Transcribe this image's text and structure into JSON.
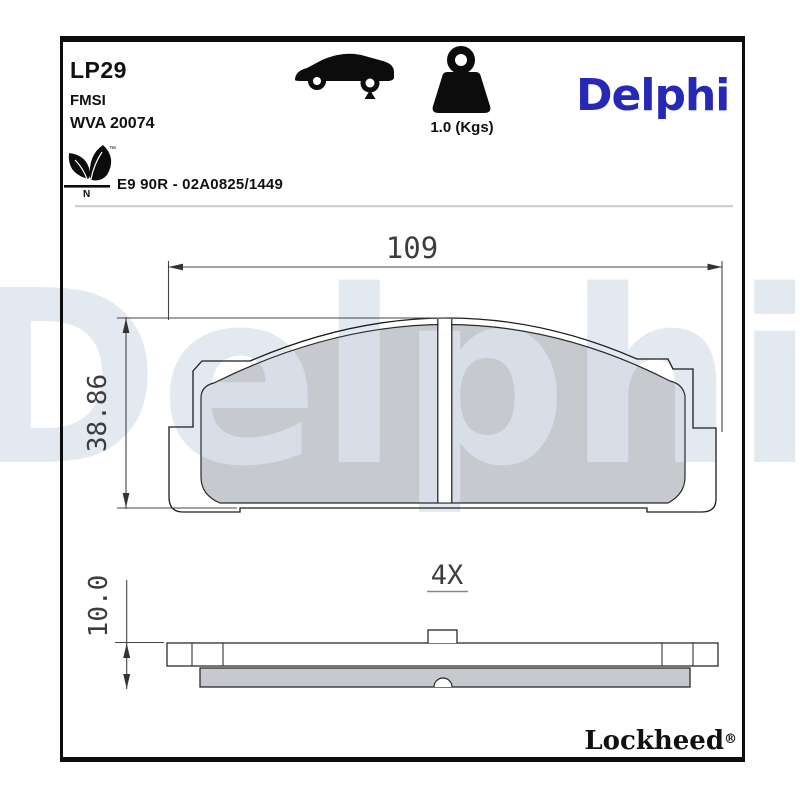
{
  "header": {
    "part_number": "LP29",
    "fmsi_label": "FMSI",
    "wva_number": "WVA 20074",
    "weight": "1.0 (Kgs)",
    "brand_logo": "Delphi",
    "approval_number": "E9 90R - 02A0825/1449",
    "eco_icon": {
      "letter": "N",
      "trademark": "™"
    }
  },
  "watermark": {
    "text": "Delphi"
  },
  "drawing": {
    "front_view": {
      "width_mm": "109",
      "height_mm": "38.86"
    },
    "side_view": {
      "thickness_mm": "10.0",
      "quantity": "4X"
    }
  },
  "footer": {
    "sub_brand": "Lockheed",
    "registered": "®"
  },
  "icons": {
    "vehicle": "car-side-icon",
    "weight": "kettlebell-weight-icon",
    "eco": "eco-leaf-icon"
  },
  "colors": {
    "brand_blue": "#2628b6",
    "pad_gray": "#c6c9ce",
    "watermark_gray": "#dce3ee",
    "line_black": "#1c1c1c"
  }
}
